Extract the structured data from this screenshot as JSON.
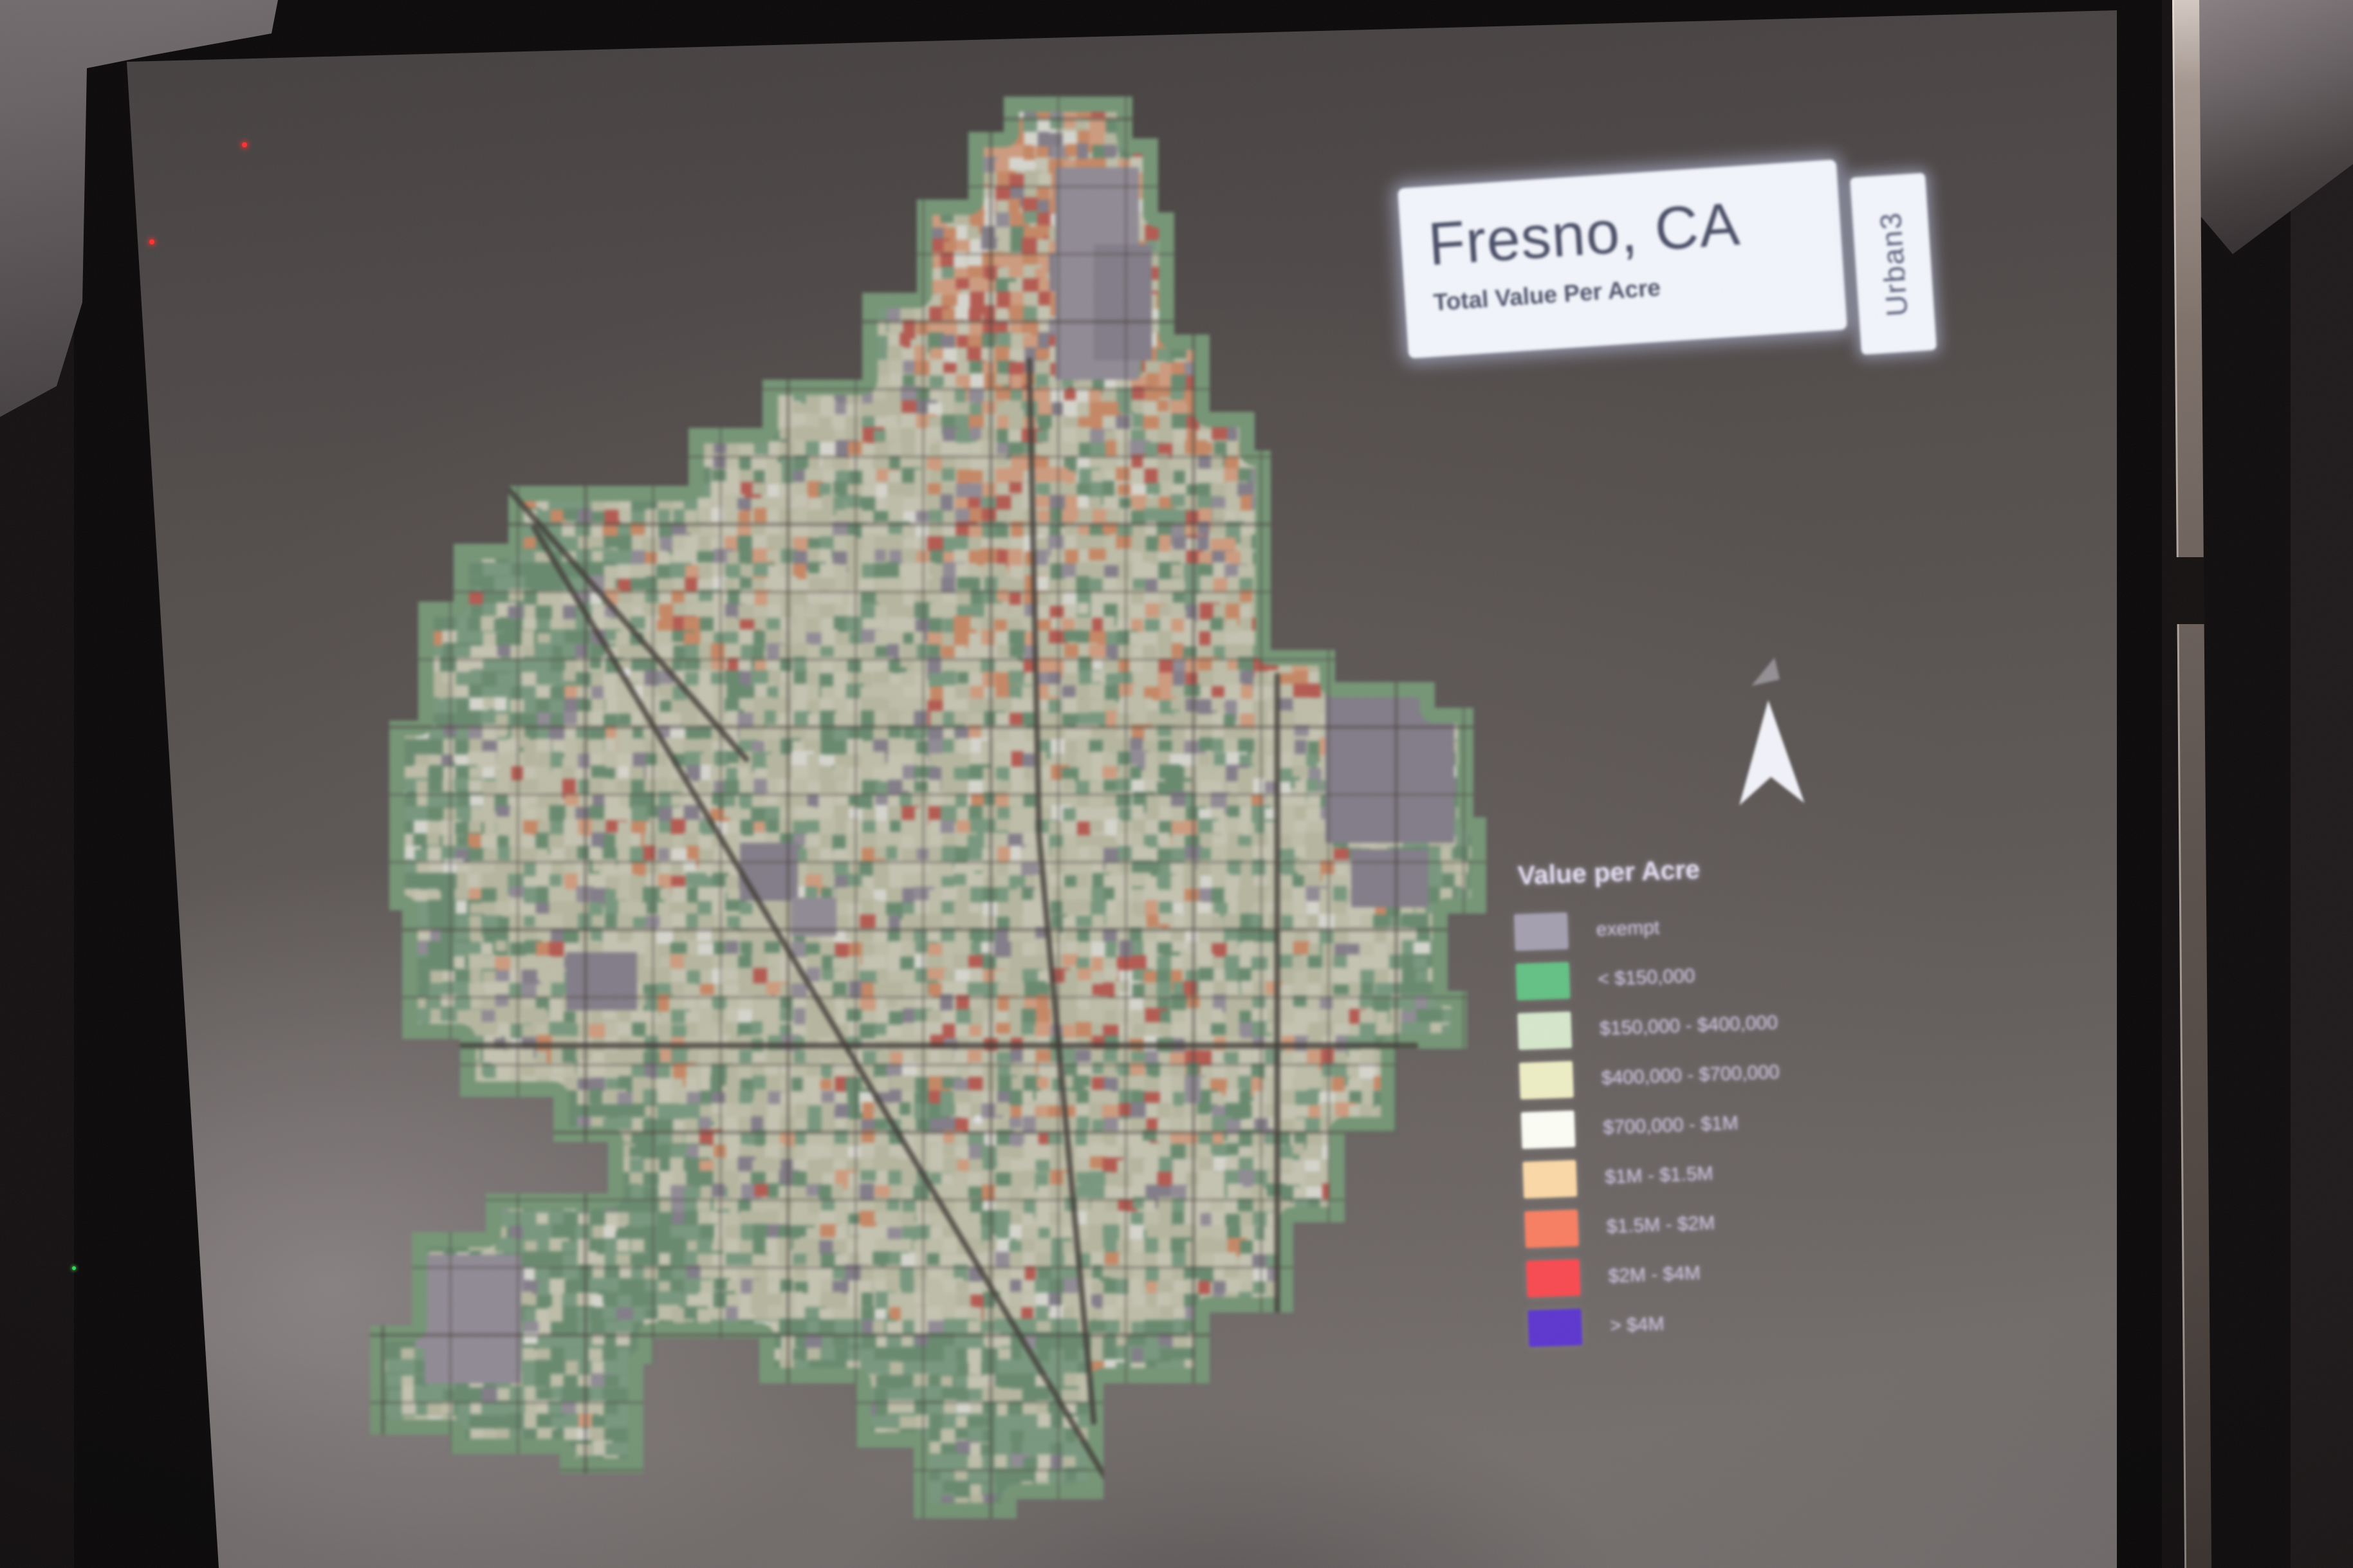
{
  "slide": {
    "title": "Fresno, CA",
    "subtitle": "Total Value Per Acre",
    "logo_text": "Urban3",
    "legend": {
      "title": "Value per Acre",
      "items": [
        {
          "label": "exempt",
          "color": "#a49fb0"
        },
        {
          "label": "< $150,000",
          "color": "#62c183"
        },
        {
          "label": "$150,000 - $400,000",
          "color": "#d5e7cb"
        },
        {
          "label": "$400,000 - $700,000",
          "color": "#eeeec4"
        },
        {
          "label": "$700,000 - $1M",
          "color": "#fcfef5"
        },
        {
          "label": "$1M - $1.5M",
          "color": "#fcd8a6"
        },
        {
          "label": "$1.5M - $2M",
          "color": "#f97e61"
        },
        {
          "label": "$2M - $4M",
          "color": "#f8494f"
        },
        {
          "label": "> $4M",
          "color": "#5c35cf"
        }
      ]
    },
    "map": {
      "region": "Fresno city parcel map, choropleth of total value per acre",
      "palette": {
        "base": "#cdcfb4",
        "base2": "#d6d6c0",
        "base3": "#c3c6a8",
        "green": "#74a07f",
        "green2": "#5f8f6c",
        "green3": "#7fae85",
        "orange": "#dd8a5c",
        "orange2": "#e6a37c",
        "red": "#c85045",
        "gray": "#837d8e",
        "gray2": "#948e9e",
        "white": "#eceee6",
        "street": "rgba(55,48,44,0.5)",
        "highway": "rgba(48,42,38,0.8)",
        "haze": "rgba(128,118,114,0.17)",
        "rim": "#6f9e74"
      }
    },
    "artifacts": {
      "laser_dot_color": "#ff2f2f",
      "led_color": "#3e4cff",
      "green_dot_color": "#39ff5a"
    }
  }
}
